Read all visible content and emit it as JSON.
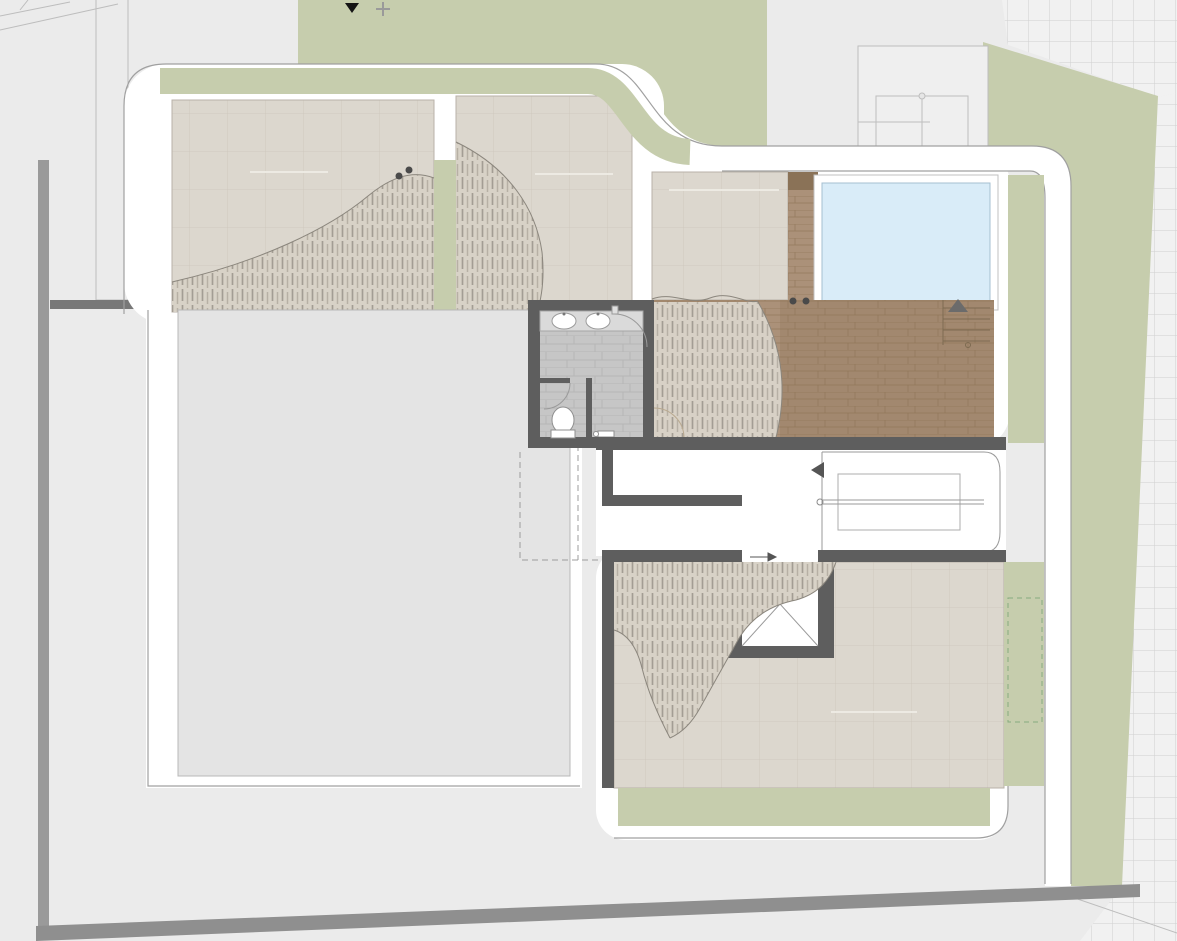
{
  "plan": {
    "title": "Roof floor site plan",
    "labels": {
      "garden_202": "202 ROOF GARDEN",
      "garden_203": "203 ROOF GARDEN",
      "garden_common": "COMMON ROOF GARDEN",
      "garden_201": "201 ROOF GARDEN"
    },
    "icons": {
      "north_marker": "▼",
      "survey_cross": "+",
      "stair_direction_arrow": "◀",
      "shaft_direction_arrow": "→",
      "pool_entry_marker": "▲"
    }
  },
  "colors": {
    "background": "#ebebeb",
    "site_green": "#c6cdad",
    "paving": "#dcd7ce",
    "paving_line": "#c9c3b9",
    "lower_floor": "#e4e4e4",
    "wood": "#ab9179",
    "wood_dark": "#8a7257",
    "pool": "#d9ecf8",
    "pool_edge": "#a5bfd0",
    "wall": "#5e5e5e",
    "road": "#8f8f8f",
    "outline": "#a0a0a0",
    "tree_gray": "#8f8f8f",
    "tree_green_1": "#7db56e",
    "tree_green_2": "#a9d69c",
    "tree_green_3": "#55a04b",
    "tree_green_4": "#8cc47e",
    "hatch": "#9a948b",
    "label_text": "#3a3a3a",
    "label_bg": "rgba(238,235,229,0.92)"
  }
}
